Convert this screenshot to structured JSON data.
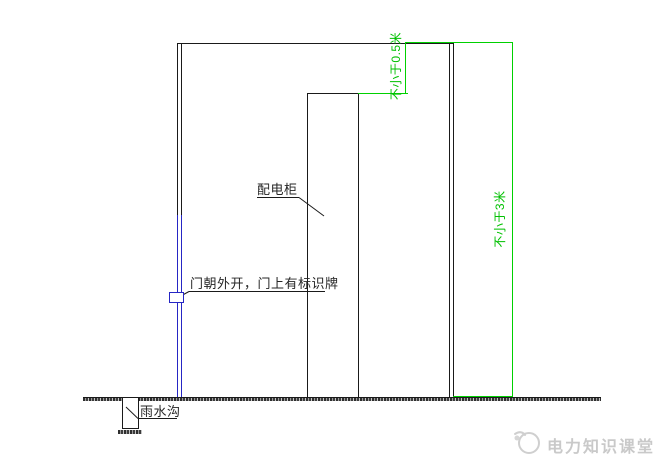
{
  "drawing": {
    "cabinet_label": "配电柜",
    "door_label": "门朝外开，门上有标识牌",
    "ditch_label": "雨水沟",
    "dim_clearance_above_cabinet": "不小于0.5米",
    "dim_room_height": "不小于3米"
  },
  "watermark": {
    "logo_icon": "power-classroom-logo",
    "text": "电力知识课堂"
  },
  "colors": {
    "line": "#1a1a1a",
    "door_blue": "#2626c4",
    "dimension_green": "#00d100",
    "watermark_gray": "#c9c9c9"
  }
}
